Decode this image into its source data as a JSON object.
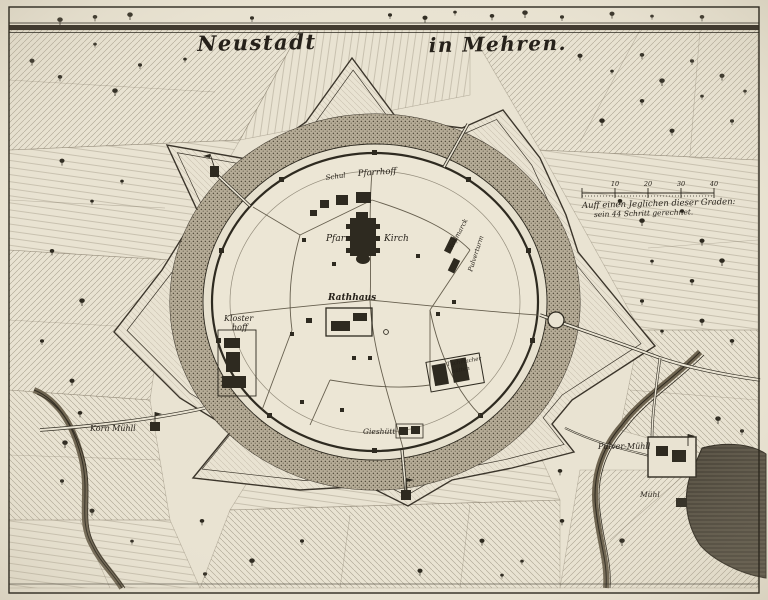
{
  "artwork": {
    "title_left": "Neustadt",
    "title_right": "in Mehren."
  },
  "scale_legend": {
    "line1": "Auff einen Jeglichen dieser Graden:",
    "line2": "sein 44 Schritt gerechnet.",
    "ticks": [
      "10",
      "20",
      "30",
      "40"
    ]
  },
  "place_labels": {
    "schul": "Schul",
    "pfarrhoff": "Pfarrhoff",
    "pfarr": "Pfarr",
    "kirch": "Kirch",
    "rathhaus": "Rathhaus",
    "kloster_1": "Kloster",
    "kloster_2": "hoff",
    "rossmarck": "Roßmarck",
    "pulverturm": "Pulverturm",
    "tuchmacher_1": "Tuchmacher",
    "tuchmacher_2": "hütten",
    "giesshuett": "Gieshütt",
    "korn_muehl": "Korn Mühll",
    "pulver_muehl": "Pulver-Mühll",
    "muehl": "Mühl"
  },
  "colors": {
    "parchment": "#e9e3d2",
    "ink": "#2e2a20",
    "moat": "#b7ad98",
    "water": "#4a4438"
  }
}
